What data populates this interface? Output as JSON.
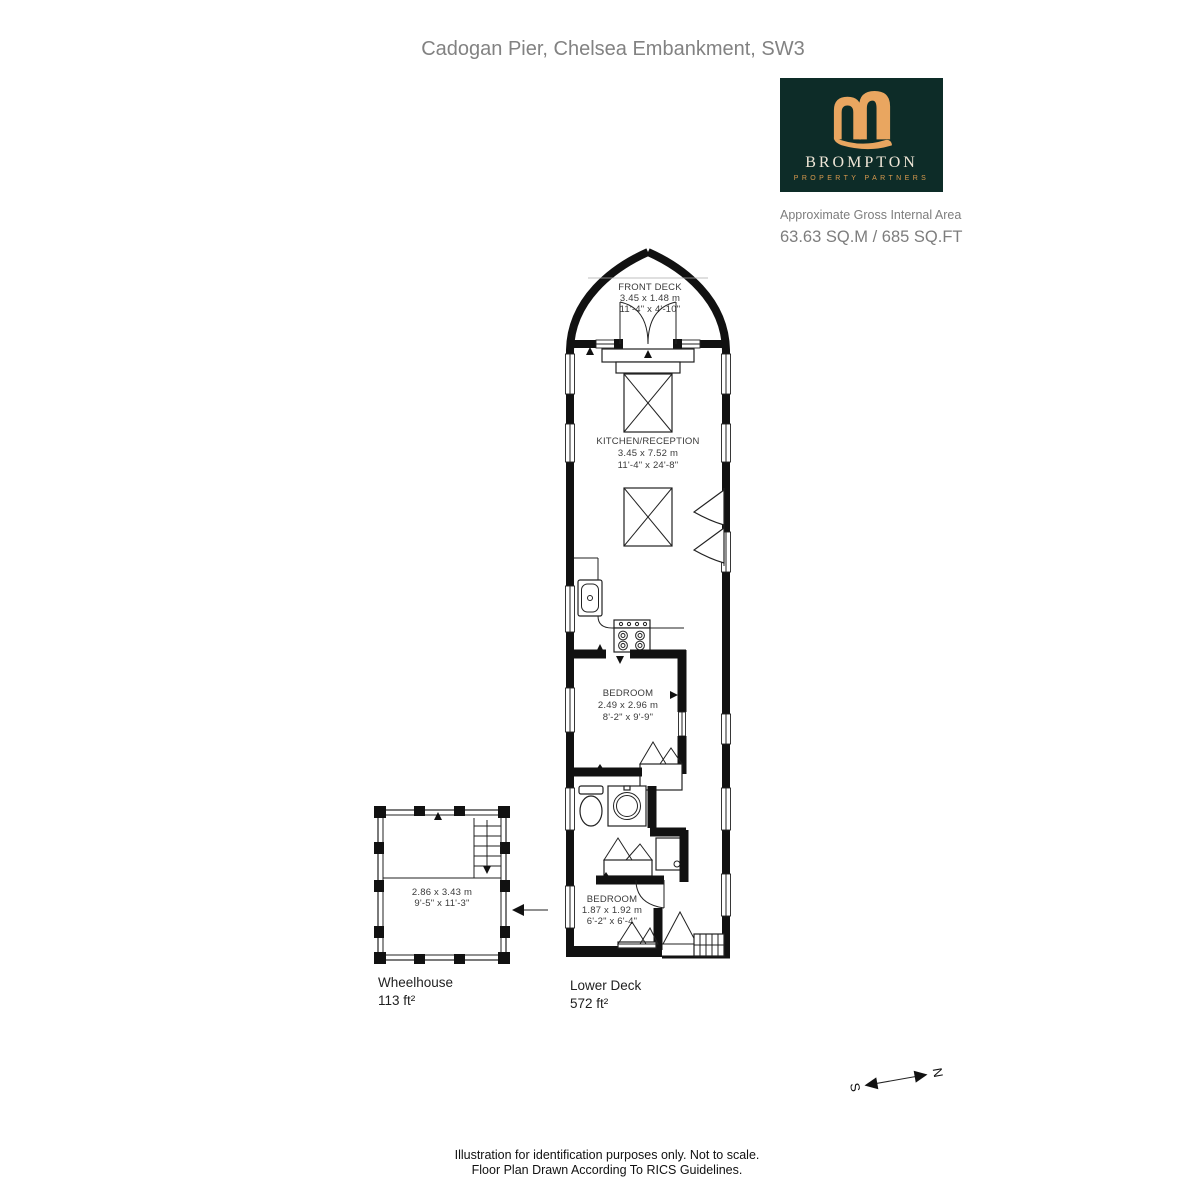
{
  "page": {
    "title": "Cadogan Pier, Chelsea Embankment, SW3",
    "footer": {
      "line1": "Illustration for identification purposes only. Not to scale.",
      "line2": "Floor Plan Drawn According To RICS Guidelines."
    }
  },
  "branding": {
    "name": "BROMPTON",
    "tagline": "PROPERTY PARTNERS",
    "colors": {
      "background": "#0d2c28",
      "gold": "#e9a660",
      "cream": "#efe6d7"
    },
    "area_label": "Approximate Gross Internal Area",
    "area_value": "63.63 SQ.M / 685 SQ.FT"
  },
  "floorplan": {
    "front_deck": {
      "name": "FRONT DECK",
      "metric": "3.45 x  1.48 m",
      "imperial": "11'-4\" x  4'-10\""
    },
    "kitchen_reception": {
      "name": "KITCHEN/RECEPTION",
      "metric": "3.45 x 7.52 m",
      "imperial": "11'-4\" x 24'-8\""
    },
    "bedroom1": {
      "name": "BEDROOM",
      "metric": "2.49 x 2.96 m",
      "imperial": "8'-2\" x 9'-9\""
    },
    "bedroom2": {
      "name": "BEDROOM",
      "metric": "1.87 x 1.92 m",
      "imperial": "6'-2\" x 6'-4\""
    },
    "wheelhouse_room": {
      "metric": "2.86 x 3.43 m",
      "imperial": "9'-5\" x 11'-3\""
    },
    "labels": {
      "wheelhouse": {
        "title": "Wheelhouse",
        "area": "113 ft²"
      },
      "lower_deck": {
        "title": "Lower Deck",
        "area": "572 ft²"
      }
    },
    "compass": {
      "south": "S",
      "north": "N"
    }
  }
}
